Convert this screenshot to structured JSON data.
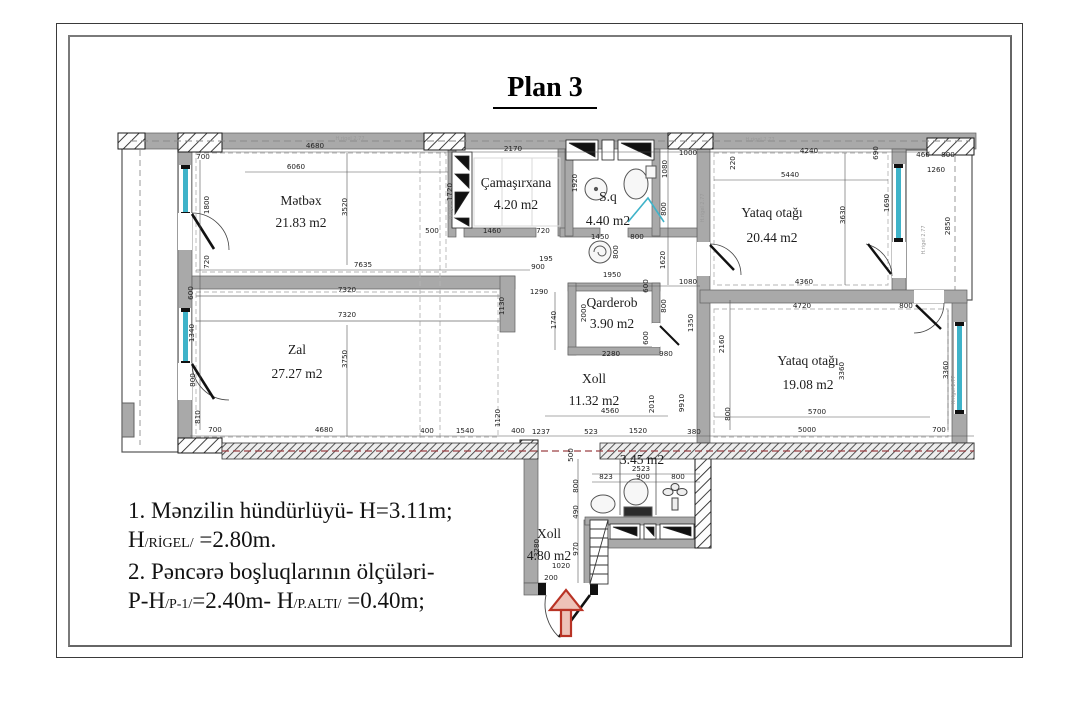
{
  "title": "Plan 3",
  "colors": {
    "wall": "#a9a9a9",
    "wall_edge": "#606060",
    "hatch": "#2a2a2a",
    "window": "#3fb3c9",
    "entrance_arrow": "#b93325",
    "beam_dashed": "#9c4044",
    "dashed": "#9a9a9a"
  },
  "rooms": [
    {
      "name": "Mətbəx",
      "area": "21.83 m2",
      "x": 301,
      "ny": 205,
      "ay": 227
    },
    {
      "name": "Çamaşırxana",
      "area": "4.20 m2",
      "x": 516,
      "ny": 187,
      "ay": 209
    },
    {
      "name": "S.q",
      "area": "4.40 m2",
      "x": 608,
      "ny": 201,
      "ay": 225
    },
    {
      "name": "Yataq otağı",
      "area": "20.44 m2",
      "x": 772,
      "ny": 217,
      "ay": 242
    },
    {
      "name": "Qarderob",
      "area": "3.90 m2",
      "x": 612,
      "ny": 307,
      "ay": 328
    },
    {
      "name": "Zal",
      "area": "27.27 m2",
      "x": 297,
      "ny": 354,
      "ay": 378
    },
    {
      "name": "Xoll",
      "area": "11.32 m2",
      "x": 594,
      "ny": 383,
      "ay": 405
    },
    {
      "name": "Yataq otağı",
      "area": "19.08 m2",
      "x": 808,
      "ny": 365,
      "ay": 389
    },
    {
      "name": "",
      "area": "3.45 m2",
      "x": 642,
      "ny": 0,
      "ay": 464
    },
    {
      "name": "Xoll",
      "area": "4.80 m2",
      "x": 549,
      "ny": 538,
      "ay": 560
    }
  ],
  "dimensions": [
    {
      "v": "700",
      "x": 203,
      "y": 159,
      "r": 0
    },
    {
      "v": "4680",
      "x": 315,
      "y": 148,
      "r": 0
    },
    {
      "v": "6060",
      "x": 296,
      "y": 169,
      "r": 0
    },
    {
      "v": "2170",
      "x": 513,
      "y": 151,
      "r": 0
    },
    {
      "v": "1000",
      "x": 688,
      "y": 155,
      "r": 0
    },
    {
      "v": "220",
      "x": 735,
      "y": 163,
      "r": 90
    },
    {
      "v": "4240",
      "x": 809,
      "y": 153,
      "r": 0
    },
    {
      "v": "5440",
      "x": 790,
      "y": 177,
      "r": 0
    },
    {
      "v": "460",
      "x": 923,
      "y": 157,
      "r": 0
    },
    {
      "v": "800",
      "x": 948,
      "y": 157,
      "r": 0
    },
    {
      "v": "1260",
      "x": 936,
      "y": 172,
      "r": 0
    },
    {
      "v": "690",
      "x": 878,
      "y": 153,
      "r": 90
    },
    {
      "v": "3520",
      "x": 347,
      "y": 207,
      "r": 90
    },
    {
      "v": "1800",
      "x": 209,
      "y": 205,
      "r": 90
    },
    {
      "v": "720",
      "x": 209,
      "y": 262,
      "r": 90
    },
    {
      "v": "1720",
      "x": 452,
      "y": 192,
      "r": 90
    },
    {
      "v": "1920",
      "x": 577,
      "y": 183,
      "r": 90
    },
    {
      "v": "1690",
      "x": 889,
      "y": 203,
      "r": 90
    },
    {
      "v": "3630",
      "x": 845,
      "y": 215,
      "r": 90
    },
    {
      "v": "2850",
      "x": 950,
      "y": 226,
      "r": 90
    },
    {
      "v": "1080",
      "x": 667,
      "y": 169,
      "r": 90
    },
    {
      "v": "800",
      "x": 666,
      "y": 209,
      "r": 90
    },
    {
      "v": "1620",
      "x": 665,
      "y": 260,
      "r": 90
    },
    {
      "v": "500",
      "x": 432,
      "y": 233,
      "r": 0
    },
    {
      "v": "1460",
      "x": 492,
      "y": 233,
      "r": 0
    },
    {
      "v": "720",
      "x": 543,
      "y": 233,
      "r": 0
    },
    {
      "v": "1450",
      "x": 600,
      "y": 239,
      "r": 0
    },
    {
      "v": "800",
      "x": 637,
      "y": 239,
      "r": 0
    },
    {
      "v": "800",
      "x": 618,
      "y": 252,
      "r": 90
    },
    {
      "v": "195",
      "x": 546,
      "y": 261,
      "r": 0
    },
    {
      "v": "900",
      "x": 538,
      "y": 269,
      "r": 0
    },
    {
      "v": "7635",
      "x": 363,
      "y": 267,
      "r": 0
    },
    {
      "v": "1290",
      "x": 539,
      "y": 294,
      "r": 0
    },
    {
      "v": "1950",
      "x": 612,
      "y": 277,
      "r": 0
    },
    {
      "v": "1080",
      "x": 688,
      "y": 284,
      "r": 0
    },
    {
      "v": "4360",
      "x": 804,
      "y": 284,
      "r": 0
    },
    {
      "v": "600",
      "x": 193,
      "y": 293,
      "r": 90
    },
    {
      "v": "7320",
      "x": 347,
      "y": 292,
      "r": 0
    },
    {
      "v": "7320",
      "x": 347,
      "y": 317,
      "r": 0
    },
    {
      "v": "1130",
      "x": 504,
      "y": 306,
      "r": 90
    },
    {
      "v": "2000",
      "x": 586,
      "y": 313,
      "r": 90
    },
    {
      "v": "1740",
      "x": 556,
      "y": 320,
      "r": 90
    },
    {
      "v": "600",
      "x": 648,
      "y": 286,
      "r": 90
    },
    {
      "v": "800",
      "x": 666,
      "y": 306,
      "r": 90
    },
    {
      "v": "1350",
      "x": 693,
      "y": 323,
      "r": 90
    },
    {
      "v": "600",
      "x": 648,
      "y": 338,
      "r": 90
    },
    {
      "v": "2280",
      "x": 611,
      "y": 356,
      "r": 0
    },
    {
      "v": "980",
      "x": 666,
      "y": 356,
      "r": 0
    },
    {
      "v": "2160",
      "x": 724,
      "y": 344,
      "r": 90
    },
    {
      "v": "4720",
      "x": 802,
      "y": 308,
      "r": 0
    },
    {
      "v": "800",
      "x": 906,
      "y": 308,
      "r": 0
    },
    {
      "v": "1340",
      "x": 194,
      "y": 333,
      "r": 90
    },
    {
      "v": "800",
      "x": 195,
      "y": 380,
      "r": 90
    },
    {
      "v": "810",
      "x": 200,
      "y": 417,
      "r": 90
    },
    {
      "v": "3750",
      "x": 347,
      "y": 359,
      "r": 90
    },
    {
      "v": "3360",
      "x": 844,
      "y": 371,
      "r": 90
    },
    {
      "v": "3360",
      "x": 948,
      "y": 370,
      "r": 90
    },
    {
      "v": "2010",
      "x": 654,
      "y": 404,
      "r": 90
    },
    {
      "v": "9910",
      "x": 684,
      "y": 403,
      "r": 90
    },
    {
      "v": "4560",
      "x": 610,
      "y": 413,
      "r": 0
    },
    {
      "v": "1120",
      "x": 500,
      "y": 418,
      "r": 90
    },
    {
      "v": "800",
      "x": 730,
      "y": 414,
      "r": 90
    },
    {
      "v": "5700",
      "x": 817,
      "y": 414,
      "r": 0
    },
    {
      "v": "700",
      "x": 215,
      "y": 432,
      "r": 0
    },
    {
      "v": "4680",
      "x": 324,
      "y": 432,
      "r": 0
    },
    {
      "v": "400",
      "x": 427,
      "y": 433,
      "r": 0
    },
    {
      "v": "1540",
      "x": 465,
      "y": 433,
      "r": 0
    },
    {
      "v": "400",
      "x": 518,
      "y": 433,
      "r": 0
    },
    {
      "v": "1237",
      "x": 541,
      "y": 434,
      "r": 0
    },
    {
      "v": "523",
      "x": 591,
      "y": 434,
      "r": 0
    },
    {
      "v": "1520",
      "x": 638,
      "y": 433,
      "r": 0
    },
    {
      "v": "380",
      "x": 694,
      "y": 434,
      "r": 0
    },
    {
      "v": "5000",
      "x": 807,
      "y": 432,
      "r": 0
    },
    {
      "v": "700",
      "x": 939,
      "y": 432,
      "r": 0
    },
    {
      "v": "500",
      "x": 573,
      "y": 455,
      "r": 90
    },
    {
      "v": "2523",
      "x": 641,
      "y": 471,
      "r": 0
    },
    {
      "v": "823",
      "x": 606,
      "y": 479,
      "r": 0
    },
    {
      "v": "900",
      "x": 643,
      "y": 479,
      "r": 0
    },
    {
      "v": "800",
      "x": 678,
      "y": 479,
      "r": 0
    },
    {
      "v": "800",
      "x": 578,
      "y": 486,
      "r": 90
    },
    {
      "v": "490",
      "x": 578,
      "y": 512,
      "r": 90
    },
    {
      "v": "3280",
      "x": 539,
      "y": 548,
      "r": 90
    },
    {
      "v": "970",
      "x": 578,
      "y": 549,
      "r": 90
    },
    {
      "v": "1020",
      "x": 561,
      "y": 568,
      "r": 0
    },
    {
      "v": "200",
      "x": 551,
      "y": 580,
      "r": 0
    }
  ],
  "wall_notes": [
    {
      "t": "H.rigel 2.77",
      "x": 452,
      "y": 205,
      "r": 90
    },
    {
      "t": "H.rigel 2.77",
      "x": 704,
      "y": 208,
      "r": 90
    },
    {
      "t": "H.rigel 2.77",
      "x": 925,
      "y": 240,
      "r": 90
    },
    {
      "t": "H.rigel 2.77",
      "x": 955,
      "y": 390,
      "r": 90
    },
    {
      "t": "H.rigel 2.77",
      "x": 350,
      "y": 140,
      "r": 0
    },
    {
      "t": "H.rigel 2.77",
      "x": 760,
      "y": 141,
      "r": 0
    }
  ],
  "notes": {
    "line1": "1. Mənzilin hündürlüyü- H=3.11m;",
    "line2": [
      {
        "t": "H"
      },
      {
        "s": "/RİGEL/"
      },
      {
        "t": " =2.80m."
      }
    ],
    "line3": "2. Pəncərə boşluqlarının ölçüləri-",
    "line4": [
      {
        "t": "P-H"
      },
      {
        "s": "/P-1/"
      },
      {
        "t": "=2.40m- H"
      },
      {
        "s": "/P.ALTI/"
      },
      {
        "t": " =0.40m;"
      }
    ]
  }
}
